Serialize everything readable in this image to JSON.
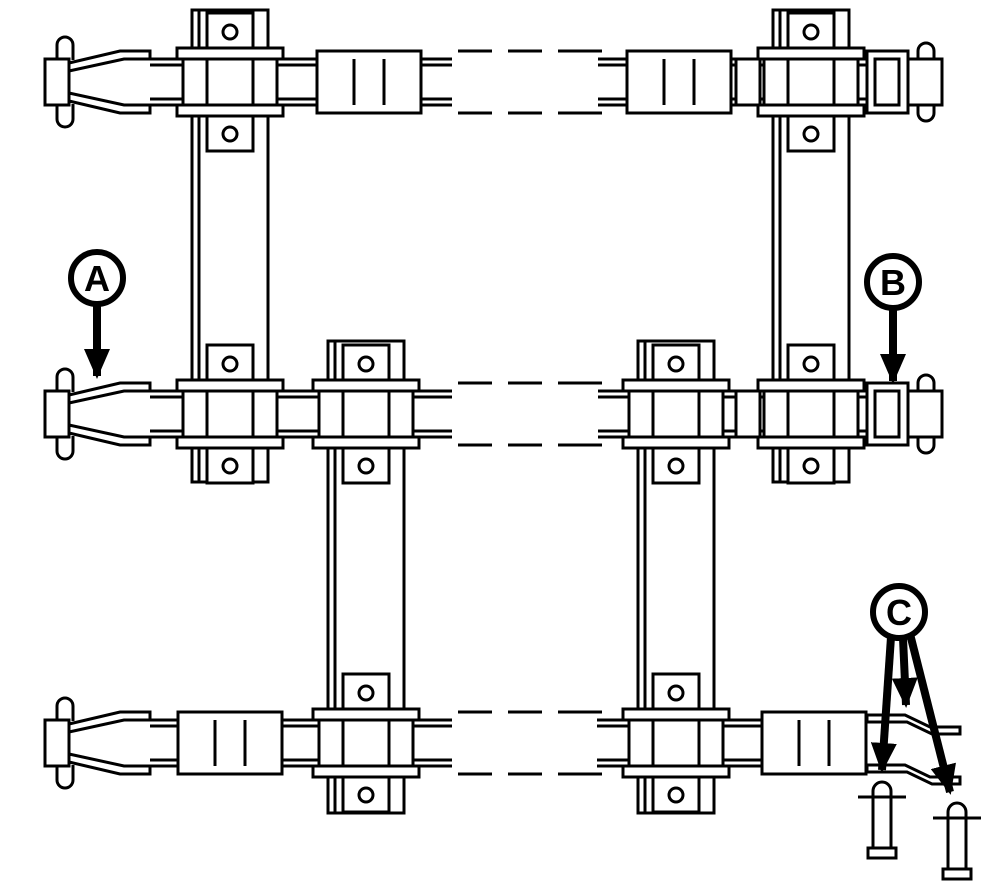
{
  "diagram": {
    "background": "#ffffff",
    "line_color": "#000000",
    "callouts": [
      {
        "label": "A"
      },
      {
        "label": "B"
      },
      {
        "label": "C"
      }
    ],
    "structure": {
      "chain_rows": 3,
      "slats": 4,
      "attachment_brackets": 8,
      "loose_pins": 2,
      "break_dash_groups_per_row": 3,
      "callout_arrow_counts": {
        "A": 1,
        "B": 1,
        "C": 3
      }
    }
  }
}
